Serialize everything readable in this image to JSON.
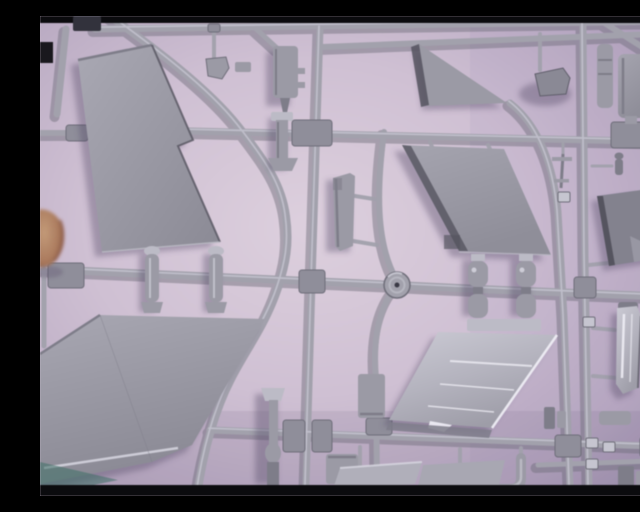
{
  "scene": {
    "type": "photograph",
    "description": "Blurry close-up photograph of a light-gray injection-moulded plastic model aircraft sprue (parts tree) lying on a pale pink-purple surface. Thin black letterbox bars run along the top and bottom edges, and a fingertip intrudes at the middle of the left edge.",
    "objects": [
      {
        "id": "tail-fin",
        "label": "vertical tail fin half"
      },
      {
        "id": "delta-wing",
        "label": "large delta wing half"
      },
      {
        "id": "small-fin",
        "label": "small triangular fin"
      },
      {
        "id": "wing-panel",
        "label": "swept wing panel"
      },
      {
        "id": "shiny-panel",
        "label": "polished wing flap panel"
      },
      {
        "id": "drop-tank",
        "label": "drop tank half"
      },
      {
        "id": "gear-leg",
        "label": "landing gear leg"
      },
      {
        "id": "keel-piece",
        "label": "fuselage keel piece"
      },
      {
        "id": "store-bodies",
        "label": "missile store halves"
      },
      {
        "id": "pylon-bodies",
        "label": "bomb and pylon bodies"
      },
      {
        "id": "intake-duct",
        "label": "shiny intake duct half"
      },
      {
        "id": "tailplane",
        "label": "dark tailplane panel"
      },
      {
        "id": "ring-part",
        "label": "small ring part"
      },
      {
        "id": "pitot",
        "label": "pitot probe part"
      },
      {
        "id": "gear-strut",
        "label": "nose gear strut"
      },
      {
        "id": "intake-lip",
        "label": "angled intake lip pieces"
      },
      {
        "id": "duct-elbow",
        "label": "curved duct elbow"
      },
      {
        "id": "runners",
        "label": "gray sprue runner frame"
      },
      {
        "id": "gate-hub",
        "label": "round injection gate hub"
      },
      {
        "id": "number-tabs",
        "label": "small part-number tabs"
      },
      {
        "id": "fingertip",
        "label": "fingertip at left photo edge"
      },
      {
        "id": "letterbox",
        "label": "black letterbox bars top and bottom"
      }
    ]
  },
  "palette": {
    "bg-hi": "#ddd0de",
    "bg-mid": "#cfc0d2",
    "bg-low": "#b6a7bf",
    "bg-edge": "#a093ad",
    "black": "#0b0b0e",
    "notch": "#32323c",
    "runner": "#a2a1ac",
    "runner-dark": "#6e6d79",
    "runner-hi": "#c9c8d4",
    "plastic": "#9b9aa5",
    "plastic-dark": "#7e7d89",
    "plastic-deep": "#55545f",
    "plastic-hi": "#bcbbc6",
    "shine": "#d9d8e2",
    "shine-hi": "#f2f1f8",
    "shadow": "rgba(82,72,98,0.38)",
    "finger": "#b98c6e",
    "finger-dark": "#8a5847",
    "teal": "#3f6f66"
  }
}
